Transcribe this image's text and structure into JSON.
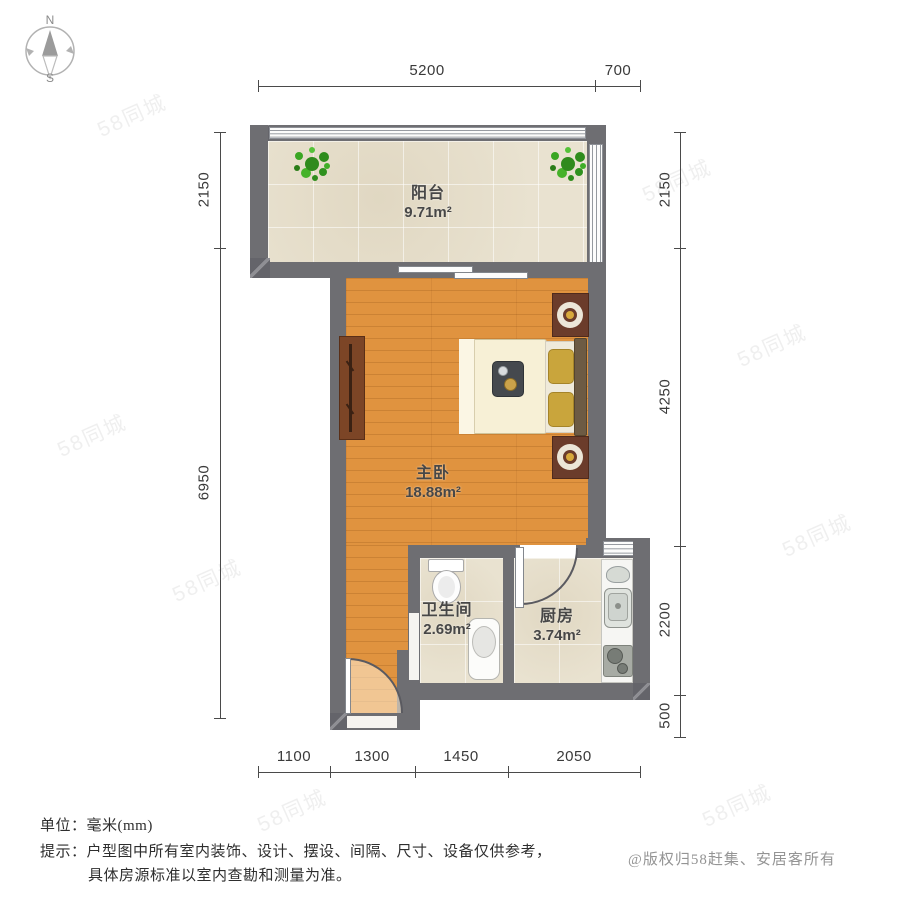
{
  "compass": {
    "north_label": "N",
    "south_label": "S"
  },
  "icons": {
    "compass": "compass-rose"
  },
  "dimensions": {
    "top": [
      "5200",
      "700"
    ],
    "left": [
      "2150",
      "6950"
    ],
    "right": [
      "2150",
      "4250",
      "2200",
      "500"
    ],
    "bottom": [
      "1100",
      "1300",
      "1450",
      "2050"
    ]
  },
  "rooms": {
    "balcony": {
      "name": "阳台",
      "area": "9.71m²"
    },
    "bedroom": {
      "name": "主卧",
      "area": "18.88m²"
    },
    "bathroom": {
      "name": "卫生间",
      "area": "2.69m²"
    },
    "kitchen": {
      "name": "厨房",
      "area": "3.74m²"
    }
  },
  "footer": {
    "unit_label": "单位：毫米(mm)",
    "tip_line1": "提示：户型图中所有室内装饰、设计、摆设、间隔、尺寸、设备仅供参考，",
    "tip_line2": "具体房源标准以室内查勘和测量为准。",
    "copyright": "@版权归58赶集、安居客所有"
  },
  "watermark": {
    "text": "58同城"
  },
  "colors": {
    "wall": "#6e6e72",
    "wood_floor": "#e0933f",
    "tile_floor": "#e9e2d0",
    "dimension_text": "#3a3a3a"
  }
}
